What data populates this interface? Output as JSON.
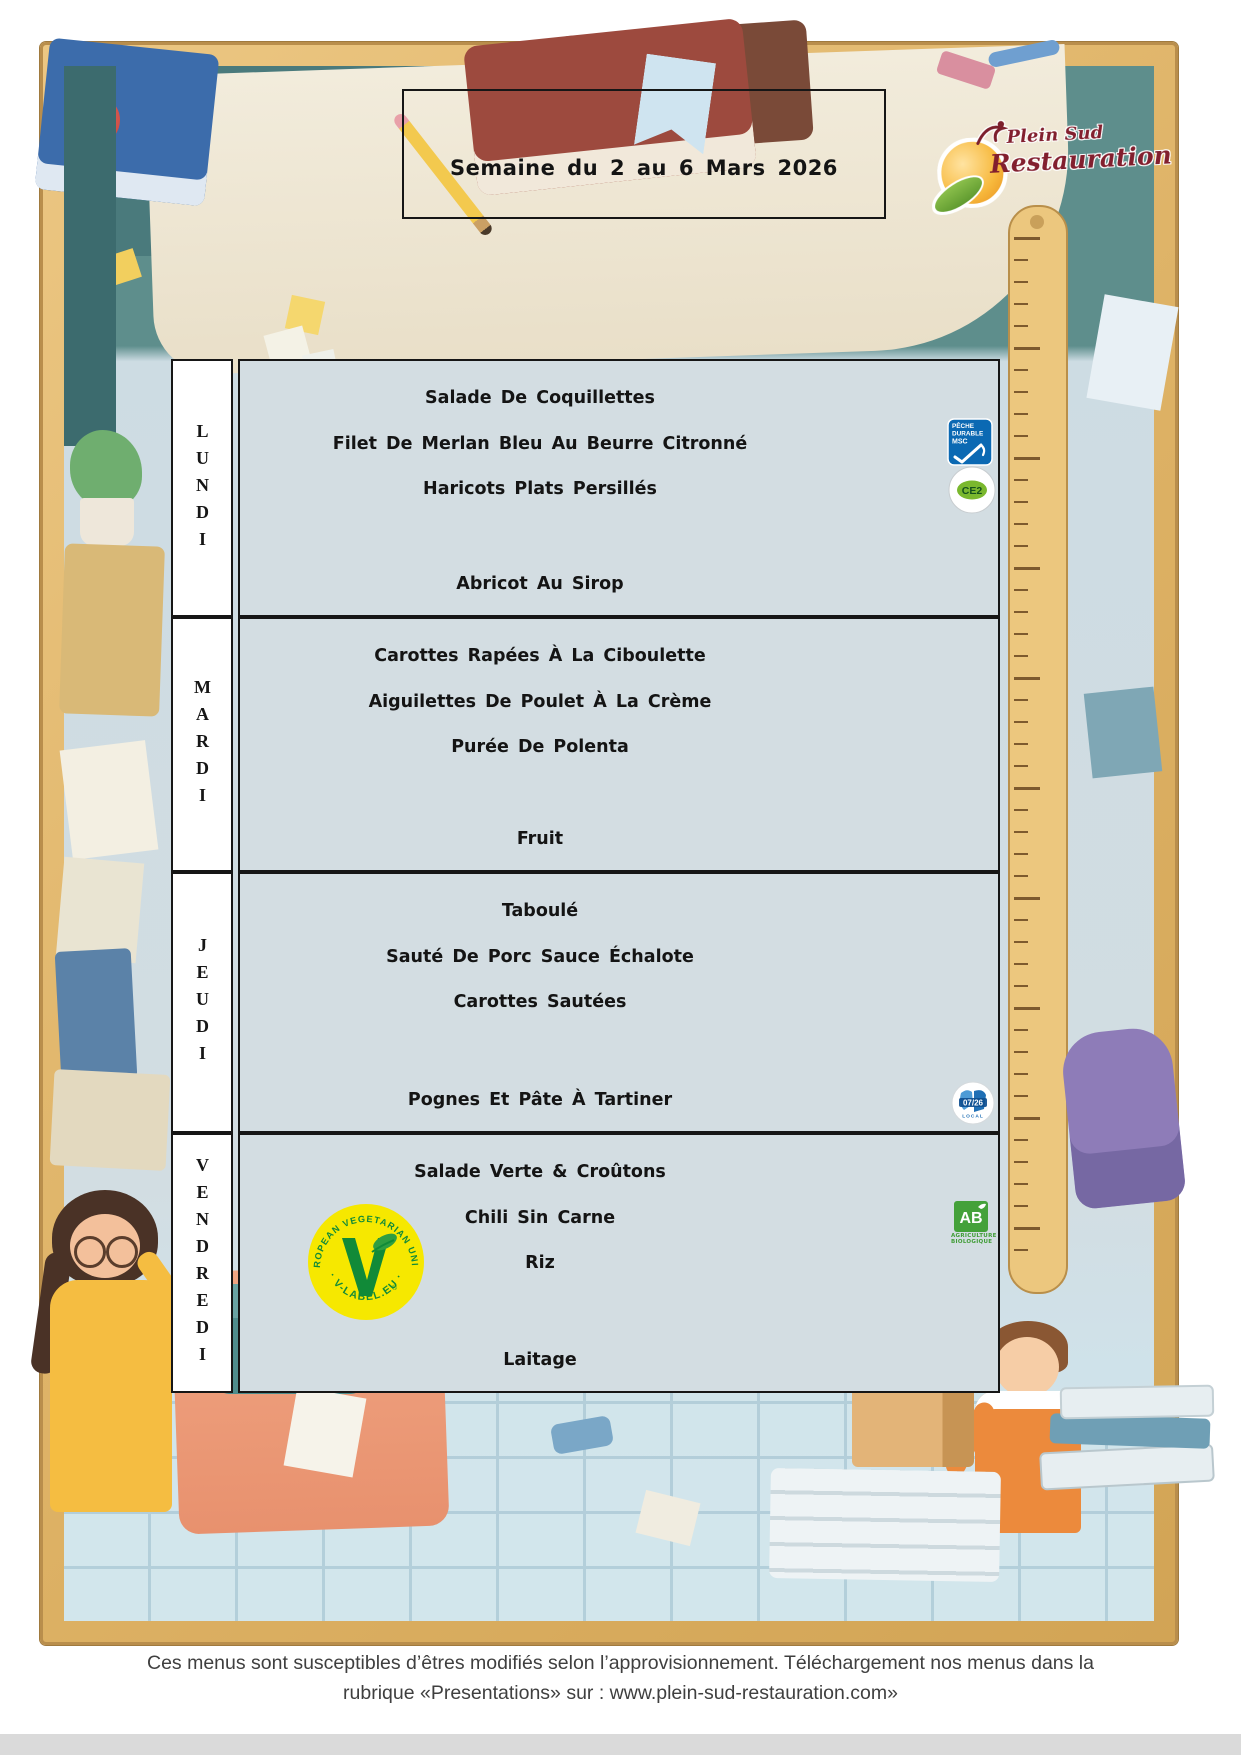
{
  "page": {
    "title": "Semaine du 2 au 6 Mars 2026",
    "footer_line1": "Ces menus sont susceptibles d’êtres modifiés selon l’approvisionnement. Téléchargement nos menus dans la",
    "footer_line2": "rubrique «Presentations» sur : www.plein-sud-restauration.com»"
  },
  "brand": {
    "logo_line1": "Plein Sud",
    "logo_line2": "Restauration"
  },
  "menu": {
    "days": [
      {
        "label": "LUNDI",
        "items": [
          "Salade De Coquillettes",
          "Filet De Merlan Bleu Au Beurre Citronné",
          "Haricots Plats Persillés",
          "Abricot Au Sirop"
        ]
      },
      {
        "label": "MARDI",
        "items": [
          "Carottes Rapées À La Ciboulette",
          "Aiguilettes De Poulet À La Crème",
          "Purée De Polenta",
          "Fruit"
        ]
      },
      {
        "label": "JEUDI",
        "items": [
          "Taboulé",
          "Sauté De Porc Sauce Échalote",
          "Carottes Sautées",
          "Pognes Et Pâte À Tartiner"
        ]
      },
      {
        "label": "VENDREDI",
        "items": [
          "Salade Verte & Croûtons",
          "Chili Sin Carne",
          "Riz",
          "Laitage"
        ]
      }
    ]
  },
  "badges": {
    "msc": {
      "line1": "PÊCHE",
      "line2": "DURABLE",
      "line3": "MSC"
    },
    "ce2": {
      "label": "CE2"
    },
    "local": {
      "label": "07/26",
      "sub": "LOCAL"
    },
    "ab": {
      "label": "AB",
      "sub1": "AGRICULTURE",
      "sub2": "BIOLOGIQUE"
    },
    "vlabel": {
      "arc_top": "EUROPEAN VEGETARIAN UNION",
      "arc_bottom": "· V-LABEL.EU ·",
      "reg": "®"
    }
  },
  "colors": {
    "accent_red": "#821f2e",
    "msc_blue": "#0b69b3",
    "ab_green": "#3f9c35",
    "vlabel_yellow": "#f6e800",
    "vlabel_green": "#118a38",
    "local_blue": "#1f6fb5",
    "table_bg": "#d3dde2",
    "frame_tan": "#ddb164"
  }
}
